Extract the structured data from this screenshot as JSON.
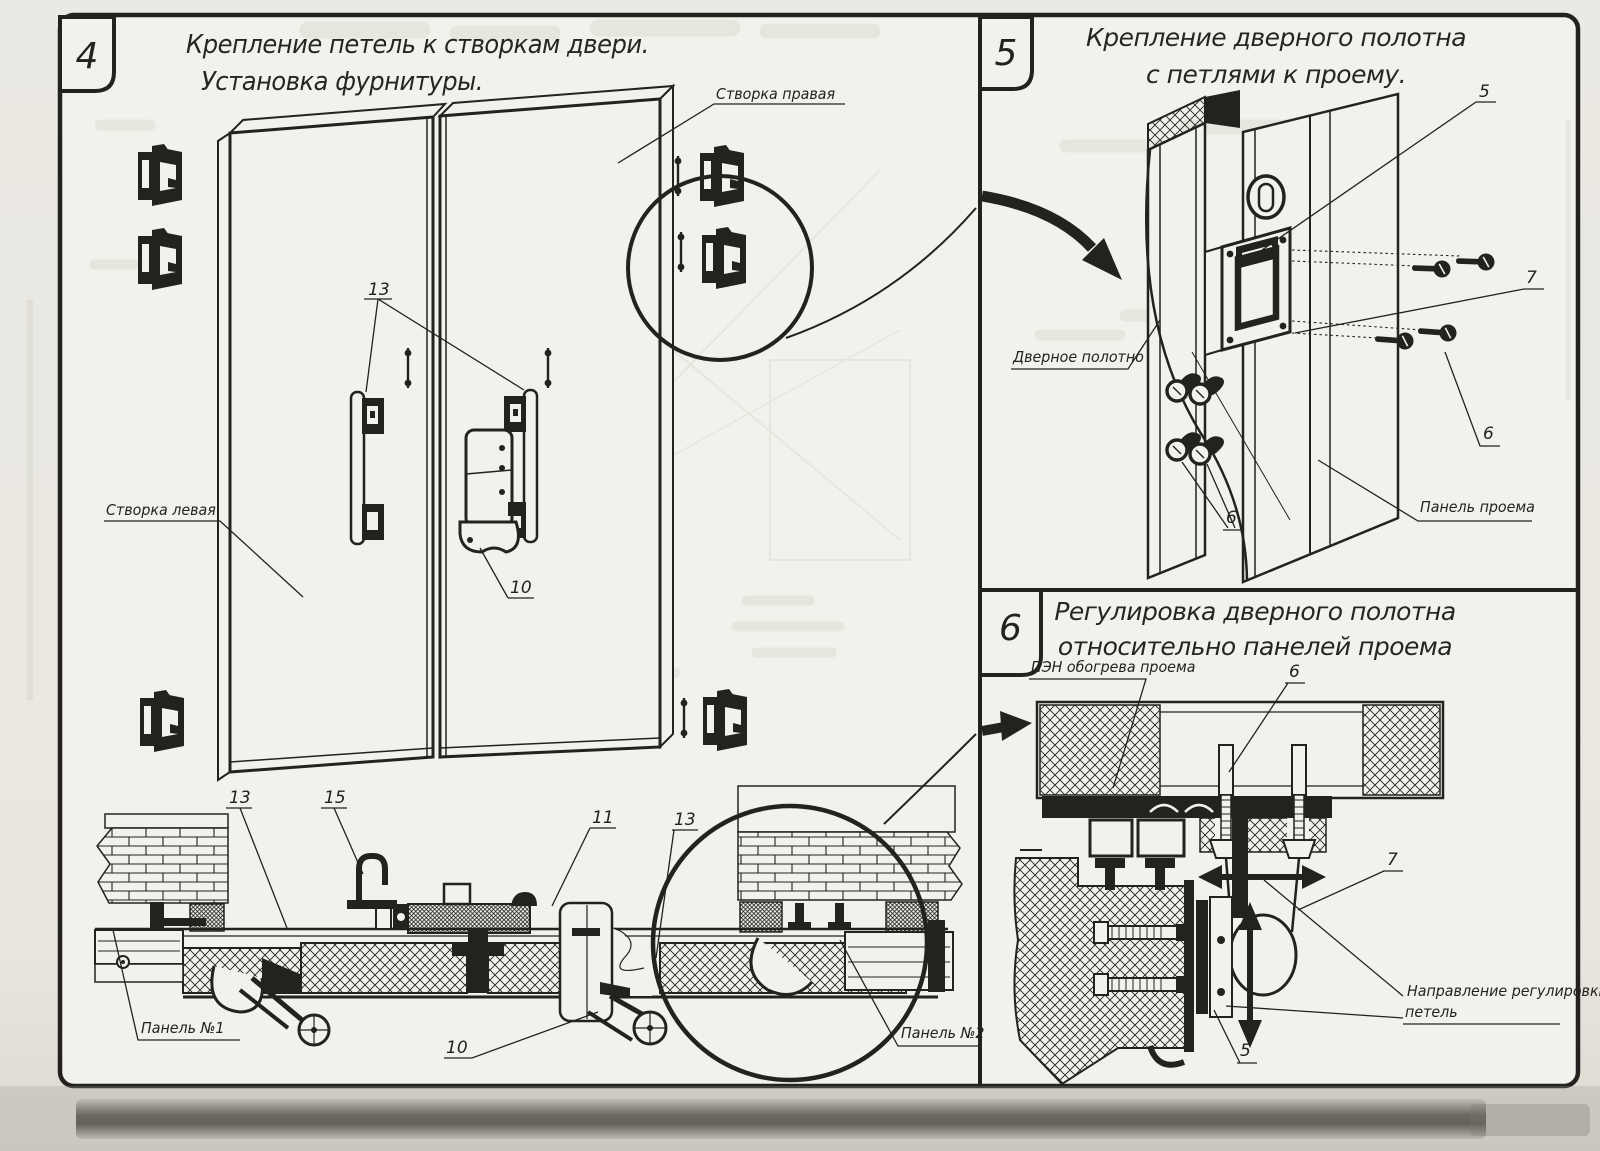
{
  "colors": {
    "ink": "#23221f",
    "paper": "#f2f1ec"
  },
  "p4": {
    "number": "4",
    "title1": "Крепление петель к створкам двери.",
    "title2": "Установка фурнитуры.",
    "labels": {
      "leaf_right": "Створка правая",
      "leaf_left": "Створка левая",
      "hinge_plates": "13",
      "lock_mid": "10",
      "section_13a": "13",
      "section_15": "15",
      "section_11": "11",
      "section_13b": "13",
      "section_10": "10",
      "panel_no1": "Панель №1",
      "panel_no2": "Панель №2"
    }
  },
  "p5": {
    "number": "5",
    "title1": "Крепление дверного полотна",
    "title2": "с петлями к проему.",
    "labels": {
      "item5": "5",
      "item7": "7",
      "item6_right": "6",
      "item6_left": "6",
      "door_leaf": "Дверное полотно",
      "opening_panel": "Панель проема"
    }
  },
  "p6": {
    "number": "6",
    "title1": "Регулировка дверного полотна",
    "title2": "относительно панелей проема",
    "labels": {
      "pen": "ПЭН обогрева проема",
      "item6": "6",
      "item7": "7",
      "direction1": "Направление регулировки",
      "direction2": "петель",
      "item5": "5"
    }
  }
}
